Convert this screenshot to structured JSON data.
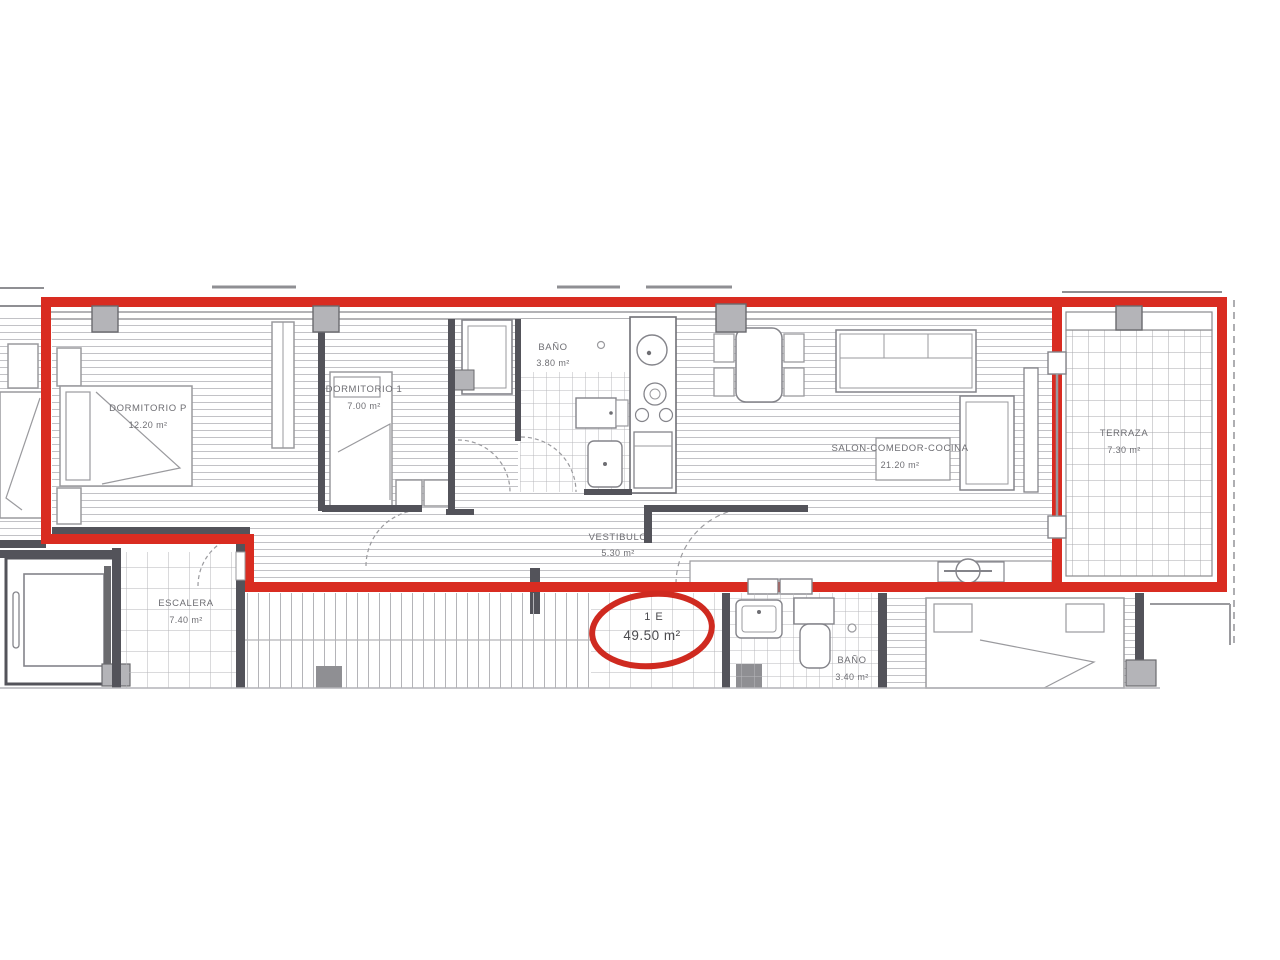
{
  "plan": {
    "title": "apartment-floor-plan",
    "unit_badge": {
      "line1": "1 E",
      "line2": "49.50 m²"
    },
    "rooms": [
      {
        "name": "DORMITORIO P",
        "area": "12.20 m²"
      },
      {
        "name": "DORMITORIO 1",
        "area": "7.00 m²"
      },
      {
        "name": "BAÑO",
        "area": "3.80 m²"
      },
      {
        "name": "SALON-COMEDOR-COCINA",
        "area": "21.20 m²"
      },
      {
        "name": "TERRAZA",
        "area": "7.30 m²"
      },
      {
        "name": "VESTIBULO",
        "area": "5.30 m²"
      },
      {
        "name": "ESCALERA",
        "area": "7.40 m²"
      },
      {
        "name": "BAÑO",
        "area": "3.40 m²"
      }
    ],
    "colors": {
      "highlight": "#d92c21",
      "walls": "#53535a",
      "hatch": "#c2c2c6",
      "label": "#6e6e73"
    }
  }
}
